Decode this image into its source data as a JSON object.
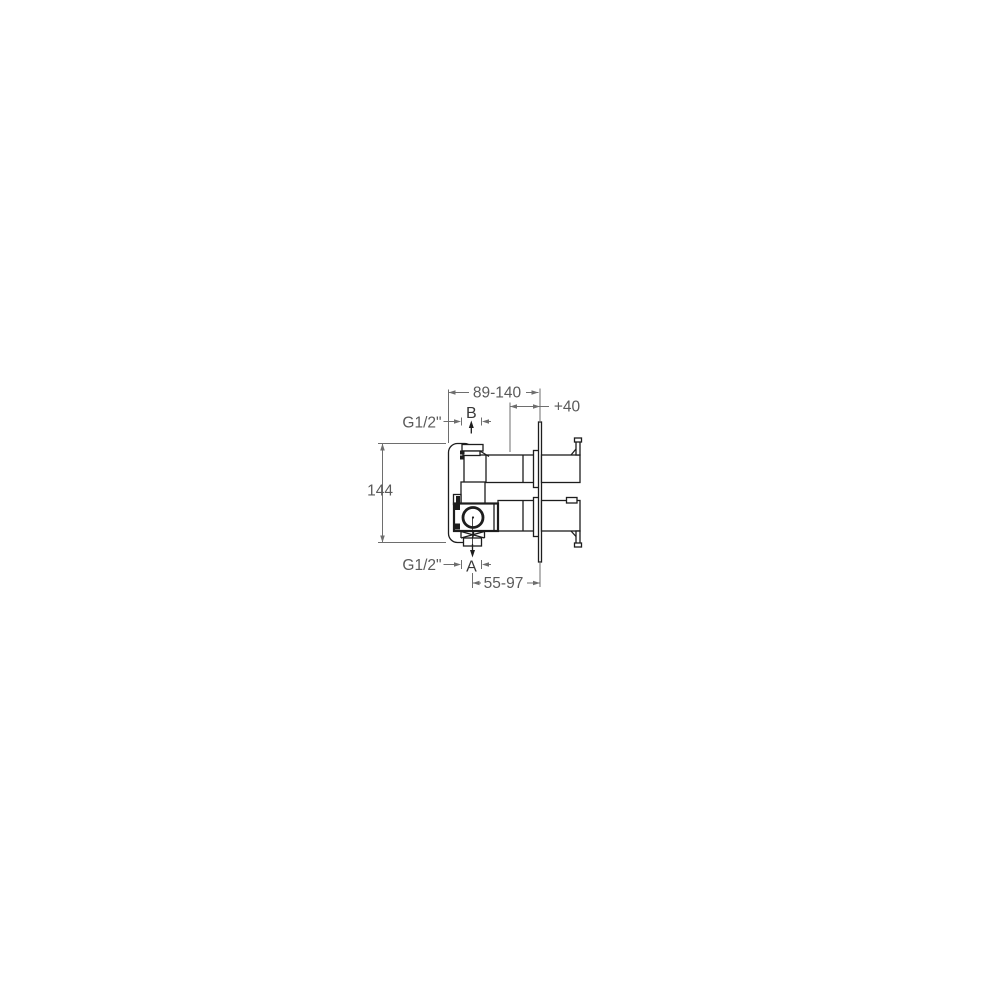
{
  "page": {
    "background_color": "#ffffff"
  },
  "drawing": {
    "kind": "technical-installation-diagram",
    "subject": "concealed shower mixer valve rough-in body, side view with mounting dimensions",
    "units_implied": "mm",
    "colors": {
      "line": "#1d1d1d",
      "dimension_line": "#6e6e6e",
      "dimension_text": "#5a5a5a",
      "port_label_text": "#383838",
      "background": "#ffffff"
    },
    "labels": {
      "depth_range": "89-140",
      "extension": "+40",
      "thread_top": "G1/2\"",
      "port_top": "B",
      "height": "144",
      "thread_bottom": "G1/2\"",
      "port_bottom": "A",
      "bottom_offset": "55-97"
    }
  }
}
